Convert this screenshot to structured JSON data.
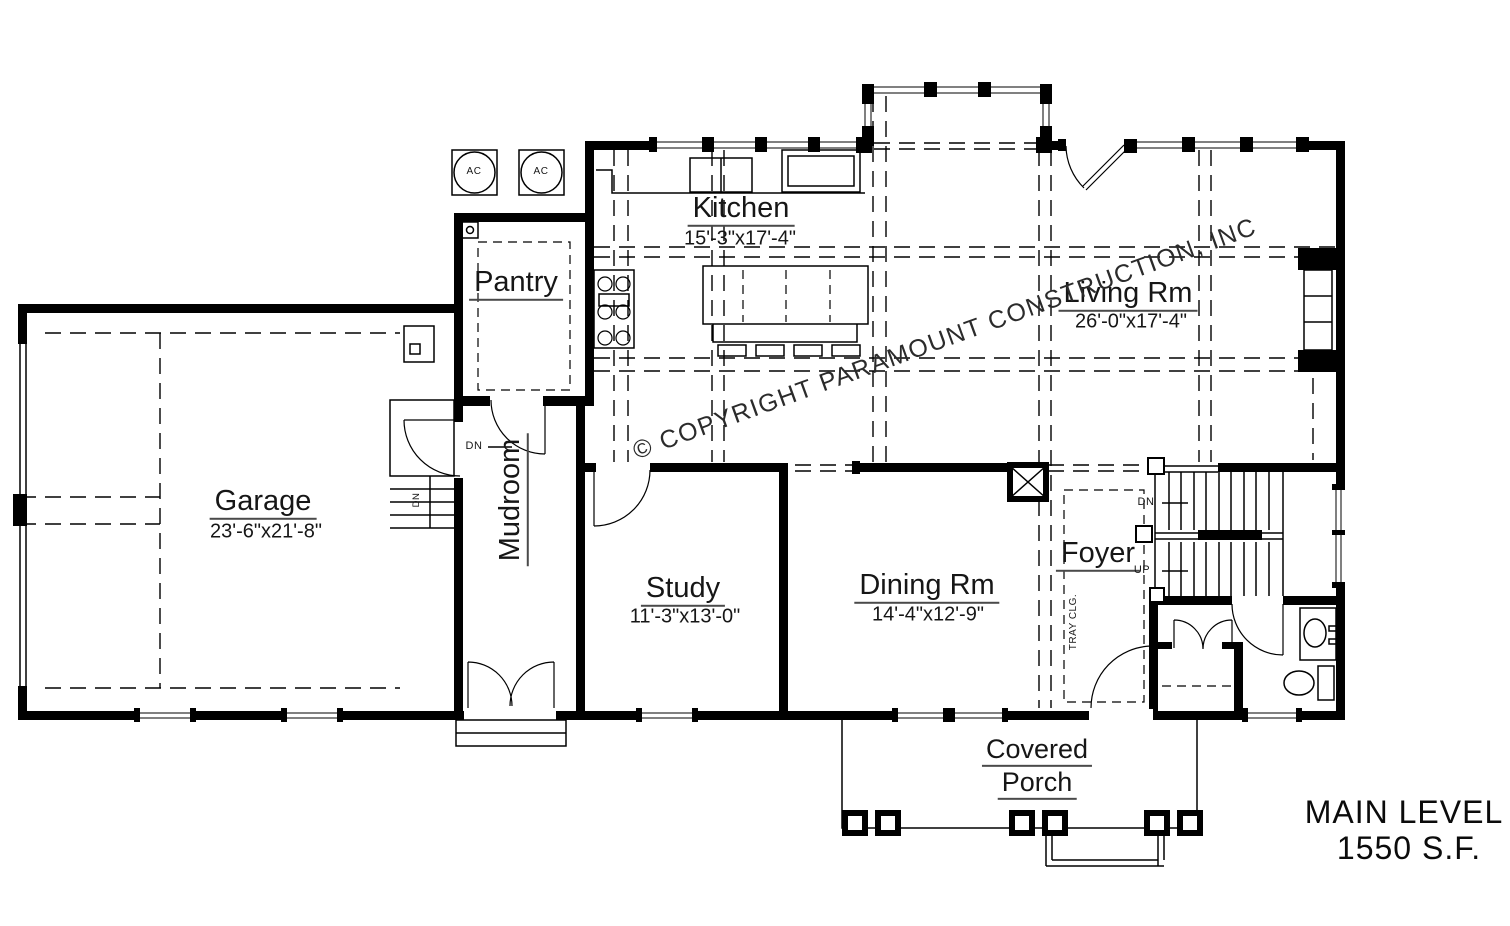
{
  "drawing": {
    "title": {
      "line1": "MAIN LEVEL",
      "line2": "1550 S.F."
    },
    "watermark": "© COPYRIGHT PARAMOUNT CONSTRUCTION, INC",
    "colors": {
      "line": "#000000",
      "background": "#ffffff",
      "label": "#161616"
    },
    "rooms": {
      "kitchen": {
        "name": "Kitchen",
        "dims": "15'-3\"x17'-4\""
      },
      "living": {
        "name": "Living Rm",
        "dims": "26'-0\"x17'-4\""
      },
      "garage": {
        "name": "Garage",
        "dims": "23'-6\"x21'-8\""
      },
      "study": {
        "name": "Study",
        "dims": "11'-3\"x13'-0\""
      },
      "dining": {
        "name": "Dining Rm",
        "dims": "14'-4\"x12'-9\""
      },
      "pantry": {
        "name": "Pantry"
      },
      "mudroom": {
        "name": "Mudroom"
      },
      "foyer": {
        "name": "Foyer"
      },
      "porch": {
        "line1": "Covered",
        "line2": "Porch"
      }
    },
    "annotations": {
      "ac": "AC",
      "dn": "DN",
      "up": "UP",
      "tray_ceiling": "TRAY CLG."
    }
  }
}
